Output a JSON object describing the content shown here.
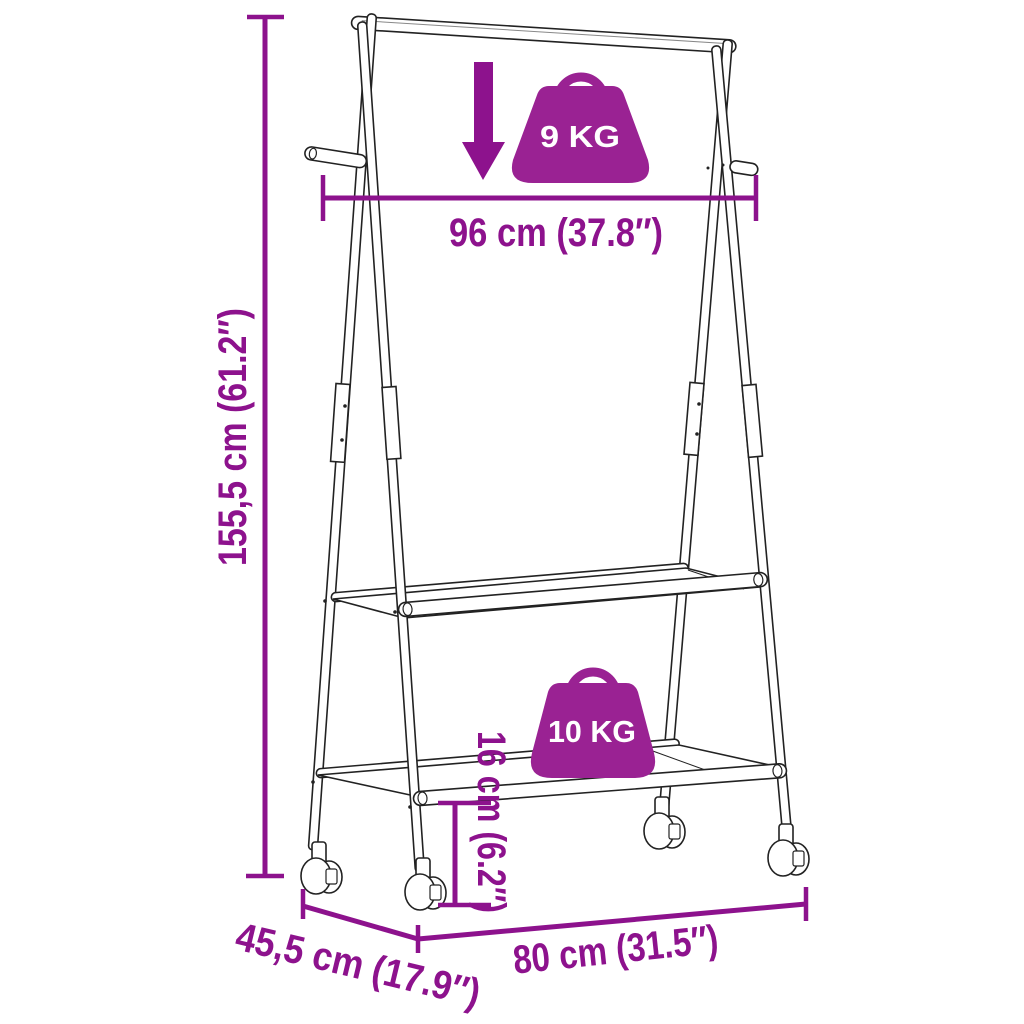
{
  "diagram": {
    "background_color": "#ffffff",
    "outline_color": "#222222",
    "annotation_color": "#8D128D",
    "badge_color": "#9A2293",
    "badge_text_color": "#ffffff",
    "labels": {
      "height": "155,5 cm (61.2″)",
      "top_width": "96 cm (37.8″)",
      "shelf_clearance": "16 cm (6.2″)",
      "bottom_width": "80 cm (31.5″)",
      "depth": "45,5 cm (17.9″)",
      "rail_capacity": "9 KG",
      "shelf_capacity": "10 KG"
    },
    "icons": {
      "rail_load": "down-arrow-icon",
      "rail_capacity": "weight-bag-icon",
      "shelf_capacity": "weight-bag-icon"
    }
  }
}
